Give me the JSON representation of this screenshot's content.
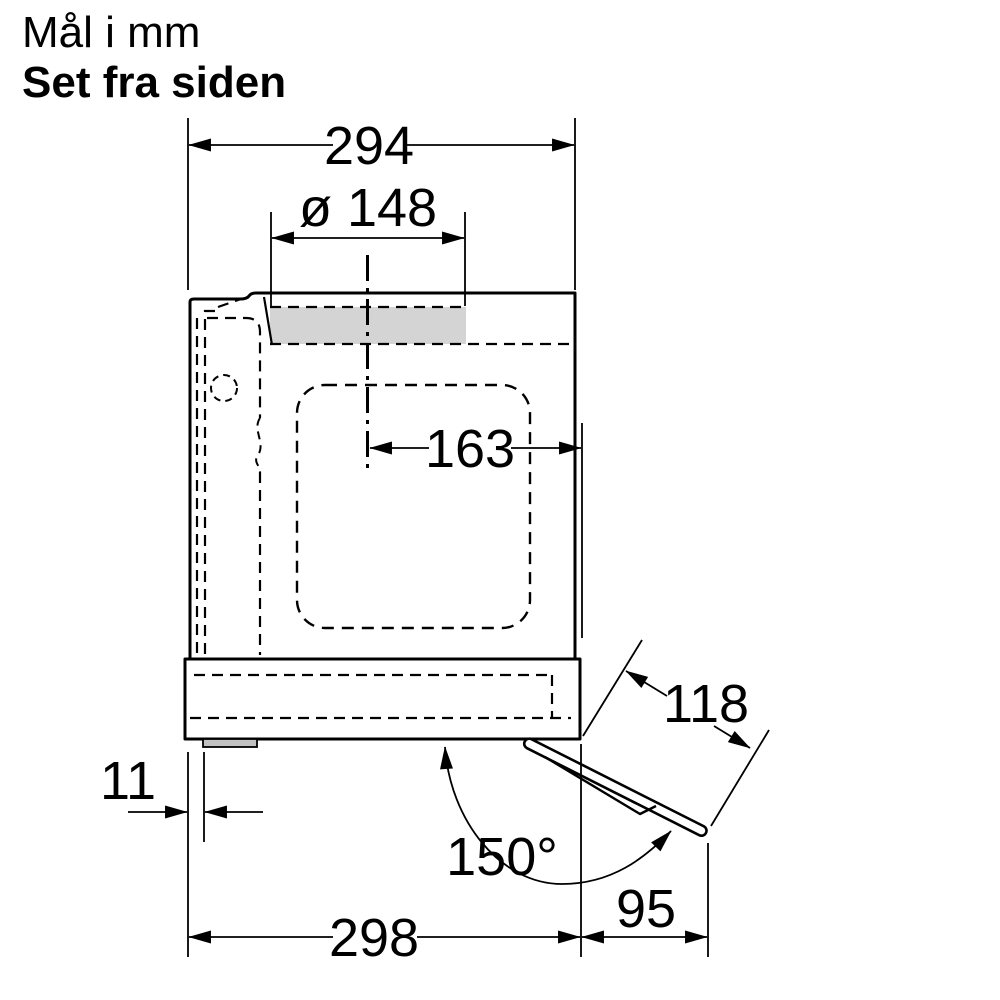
{
  "header": {
    "units_line": "Mål i mm",
    "view_line": "Set fra siden"
  },
  "dimensions": {
    "top_width": "294",
    "duct_diameter": "ø 148",
    "duct_center_offset": "163",
    "left_offset": "11",
    "opening_angle": "150°",
    "flap_length": "118",
    "body_depth": "298",
    "flap_projection": "95"
  },
  "colors": {
    "line": "#000000",
    "duct_fill": "#d4d4d4",
    "foot_fill": "#c2c2c2",
    "background": "#ffffff"
  }
}
